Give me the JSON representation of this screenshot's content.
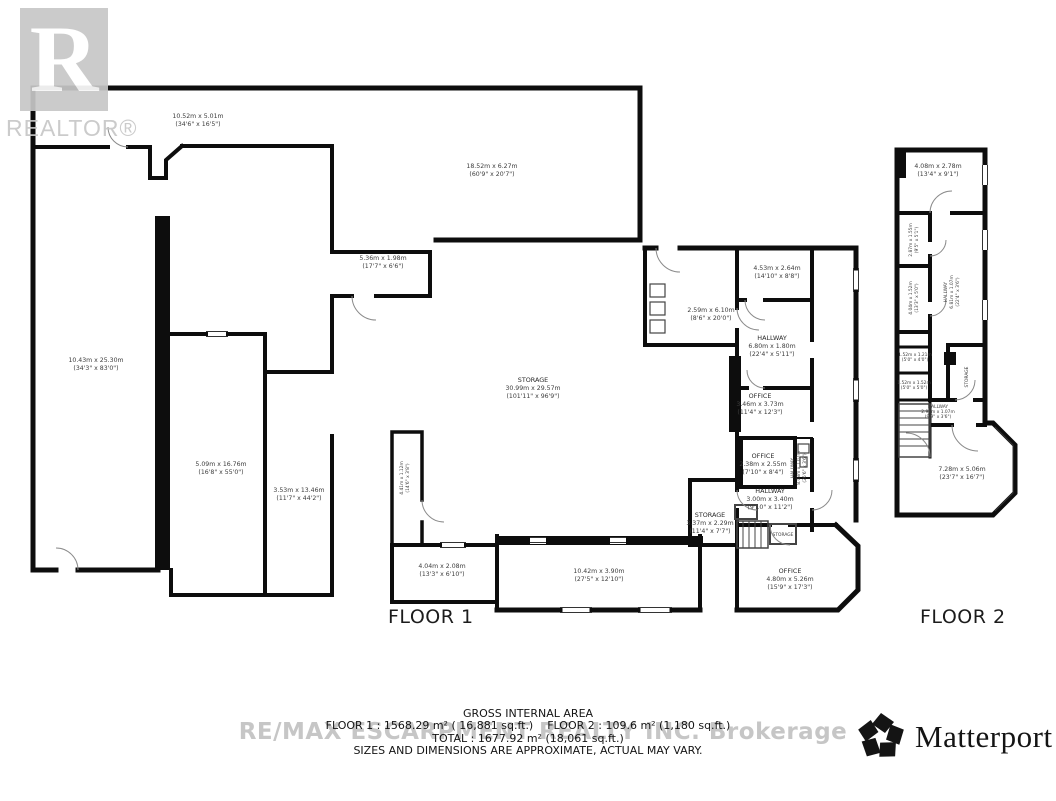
{
  "branding": {
    "realtor_logo_letter": "R",
    "realtor_logo_text": "REALTOR®",
    "watermark": "RE/MAX ESCARPMENT REALTY INC. Brokerage",
    "matterport": "Matterport",
    "matterport_reg": "®"
  },
  "footer": {
    "title": "GROSS INTERNAL AREA",
    "floor1_area": "FLOOR 1 : 1568.29 m² ( 16,881 sq.ft.)",
    "floor2_area": "FLOOR 2 : 109.6 m² (1,180 sq.ft.)",
    "total": "TOTAL : 1677.92 m² (18,061 sq.ft.)",
    "disclaimer": "SIZES AND DIMENSIONS ARE APPROXIMATE, ACTUAL MAY VARY."
  },
  "floor1": {
    "label": "FLOOR 1",
    "rooms": [
      {
        "metric": "10.52m x 5.01m",
        "imperial": "(34'6\" x 16'5\")"
      },
      {
        "metric": "18.52m x 6.27m",
        "imperial": "(60'9\" x 20'7\")"
      },
      {
        "metric": "10.43m x 25.30m",
        "imperial": "(34'3\" x 83'0\")"
      },
      {
        "metric": "5.09m x 16.76m",
        "imperial": "(16'8\" x 55'0\")"
      },
      {
        "metric": "3.53m x 13.46m",
        "imperial": "(11'7\" x 44'2\")"
      },
      {
        "metric": "5.36m x 1.98m",
        "imperial": "(17'7\" x 6'6\")"
      },
      {
        "name": "STORAGE",
        "metric": "30.99m x 29.57m",
        "imperial": "(101'11\" x 96'9\")"
      },
      {
        "metric": "2.59m x 6.10m",
        "imperial": "(8'6\" x 20'0\")"
      },
      {
        "metric": "4.53m x 2.64m",
        "imperial": "(14'10\" x 8'8\")"
      },
      {
        "name": "HALLWAY",
        "metric": "6.80m x 1.80m",
        "imperial": "(22'4\" x 5'11\")"
      },
      {
        "name": "OFFICE",
        "metric": "3.46m x 3.73m",
        "imperial": "(11'4\" x 12'3\")"
      },
      {
        "name": "OFFICE",
        "metric": "2.38m x 2.55m",
        "imperial": "(7'10\" x 8'4\")"
      },
      {
        "name": "HALLWAY",
        "metric": "3.00m x 3.40m",
        "imperial": "(9'10\" x 11'2\")"
      },
      {
        "name": "STORAGE",
        "metric": "3.37m x 2.29m",
        "imperial": "(11'4\" x 7'7\")"
      },
      {
        "name": "STORAGE"
      },
      {
        "name": "OFFICE",
        "metric": "4.80m x 5.26m",
        "imperial": "(15'9\" x 17'3\")"
      },
      {
        "metric": "4.04m x 2.08m",
        "imperial": "(13'3\" x 6'10\")"
      },
      {
        "metric": "10.42m x 3.90m",
        "imperial": "(27'5\" x 12'10\")"
      },
      {
        "metric": "4.41m x 1.12m",
        "imperial": "(14'6\" x 3'8\")"
      },
      {
        "name": "HALLWAY",
        "metric": "8.08m x 1.07m",
        "imperial": "(26'6\" x 3'6\")"
      }
    ]
  },
  "floor2": {
    "label": "FLOOR 2",
    "rooms": [
      {
        "metric": "4.08m x 2.78m",
        "imperial": "(13'4\" x 9'1\")"
      },
      {
        "metric": "2.87m x 1.55m",
        "imperial": "(9'5\" x 5'1\")"
      },
      {
        "metric": "4.04m x 1.52m",
        "imperial": "(13'3\" x 5'0\")"
      },
      {
        "name": "HALLWAY",
        "metric": "6.81m x 1.07m",
        "imperial": "(22'4\" x 3'6\")"
      },
      {
        "metric": "1.52m x 1.21m",
        "imperial": "(5'0\" x 4'0\")"
      },
      {
        "metric": "1.52m x 1.52m",
        "imperial": "(5'0\" x 5'0\")"
      },
      {
        "name": "HALLWAY",
        "metric": "2.97m x 1.07m",
        "imperial": "(9'9\" x 3'6\")"
      },
      {
        "name": "STORAGE"
      },
      {
        "metric": "7.28m x 5.06m",
        "imperial": "(23'7\" x 16'7\")"
      }
    ]
  }
}
